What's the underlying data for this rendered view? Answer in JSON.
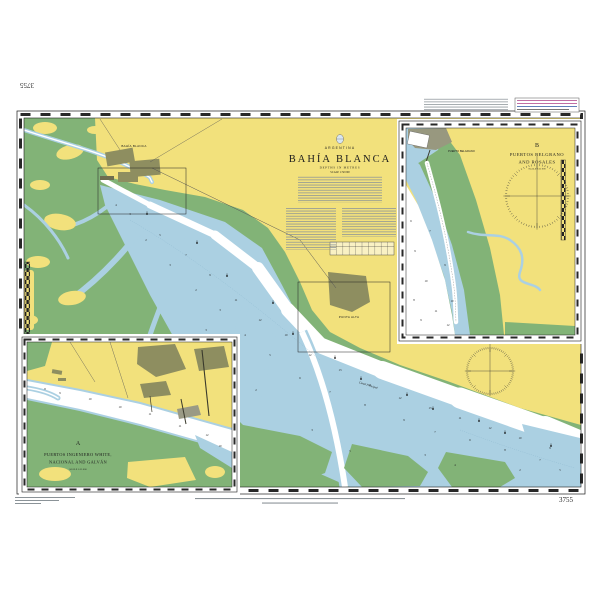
{
  "chart": {
    "number": "3755",
    "country": "ARGENTINA",
    "title": "BAHÍA BLANCA",
    "depths": "DEPTHS IN METRES",
    "scale": "SCALE 1:50 000"
  },
  "insets": {
    "a": {
      "letter": "A",
      "line1": "PUERTOS INGENIERO WHITE,",
      "line2": "NACIONAL AND GALVÁN",
      "scale": "SCALE 1:25 000"
    },
    "b": {
      "letter": "B",
      "line1": "PUERTOS BELGRANO",
      "line2": "AND ROSALES",
      "scale": "SCALE 1:25 000"
    }
  },
  "labels": {
    "city_main": "BAHÍA BLANCA",
    "city_secondary": "PUNTA ALTA",
    "naval_base": "PUERTO BELGRANO",
    "channel": "Canal Principal"
  },
  "colors": {
    "land": "#f2e17c",
    "flats": "#82b377",
    "shallow": "#abd0e2",
    "deep": "#ffffff",
    "builtup": "#8e8e60",
    "magenta": "#b04a8e",
    "frame": "#1c1c1c"
  },
  "map": {
    "roses": [
      {
        "cx": 490,
        "cy": 371,
        "r": 24
      },
      {
        "cx": 537,
        "cy": 196,
        "r": 32
      }
    ],
    "soundings_main": [
      [
        130,
        215,
        "3"
      ],
      [
        160,
        236,
        "5"
      ],
      [
        186,
        256,
        "7"
      ],
      [
        210,
        276,
        "9"
      ],
      [
        236,
        301,
        "11"
      ],
      [
        260,
        321,
        "12"
      ],
      [
        286,
        336,
        "10"
      ],
      [
        310,
        356,
        "12"
      ],
      [
        340,
        371,
        "13"
      ],
      [
        370,
        386,
        "11"
      ],
      [
        400,
        399,
        "12"
      ],
      [
        430,
        409,
        "13"
      ],
      [
        460,
        419,
        "11"
      ],
      [
        490,
        429,
        "12"
      ],
      [
        520,
        439,
        "10"
      ],
      [
        550,
        449,
        "9"
      ],
      [
        560,
        471,
        "5"
      ],
      [
        540,
        461,
        "7"
      ],
      [
        505,
        451,
        "8"
      ],
      [
        470,
        441,
        "6"
      ],
      [
        435,
        433,
        "7"
      ],
      [
        404,
        421,
        "9"
      ],
      [
        365,
        406,
        "8"
      ],
      [
        330,
        393,
        "7"
      ],
      [
        300,
        379,
        "6"
      ],
      [
        270,
        356,
        "5"
      ],
      [
        245,
        336,
        "4"
      ],
      [
        220,
        311,
        "3"
      ],
      [
        196,
        291,
        "2"
      ],
      [
        170,
        266,
        "3"
      ],
      [
        146,
        241,
        "2"
      ],
      [
        116,
        206,
        "4"
      ],
      [
        425,
        456,
        "3"
      ],
      [
        455,
        466,
        "4"
      ],
      [
        520,
        471,
        "2"
      ],
      [
        350,
        452,
        "5"
      ],
      [
        312,
        431,
        "3"
      ],
      [
        256,
        391,
        "2"
      ],
      [
        231,
        361,
        "4"
      ],
      [
        206,
        331,
        "3"
      ]
    ],
    "soundings_inset_a": [
      [
        60,
        394,
        "9"
      ],
      [
        90,
        400,
        "10"
      ],
      [
        120,
        408,
        "10"
      ],
      [
        150,
        415,
        "11"
      ],
      [
        180,
        427,
        "11"
      ],
      [
        207,
        436,
        "12"
      ],
      [
        45,
        390,
        "8"
      ],
      [
        220,
        447,
        "10"
      ]
    ],
    "soundings_inset_b": [
      [
        415,
        252,
        "9"
      ],
      [
        426,
        282,
        "10"
      ],
      [
        436,
        312,
        "11"
      ],
      [
        448,
        326,
        "12"
      ],
      [
        414,
        301,
        "8"
      ],
      [
        411,
        222,
        "6"
      ],
      [
        430,
        232,
        "7"
      ],
      [
        445,
        266,
        "9"
      ],
      [
        452,
        302,
        "10"
      ],
      [
        421,
        321,
        "9"
      ]
    ],
    "buoys": [
      [
        152,
        214
      ],
      [
        192,
        243
      ],
      [
        232,
        276
      ],
      [
        268,
        303
      ],
      [
        298,
        334
      ],
      [
        330,
        358
      ],
      [
        366,
        379
      ],
      [
        402,
        395
      ],
      [
        438,
        409
      ],
      [
        474,
        421
      ],
      [
        510,
        433
      ],
      [
        546,
        446
      ]
    ]
  }
}
